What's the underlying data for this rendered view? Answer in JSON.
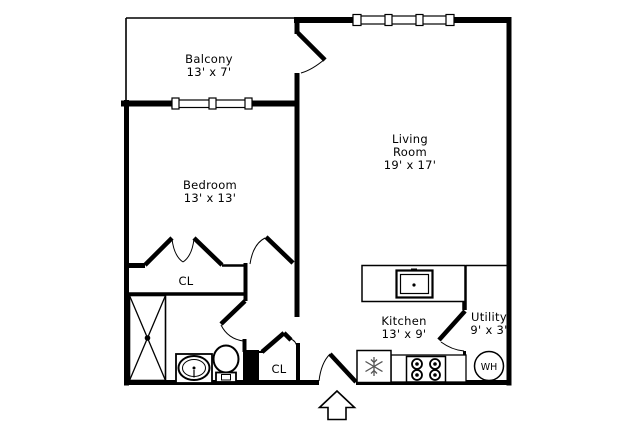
{
  "canvas": {
    "background": "#ffffff",
    "line_color": "#000000"
  },
  "rooms": {
    "balcony": {
      "lines": [
        "Balcony",
        "13' x 7'"
      ]
    },
    "living": {
      "lines": [
        "Living",
        "Room",
        "19' x 17'"
      ]
    },
    "bedroom": {
      "lines": [
        "Bedroom",
        "13' x 13'"
      ]
    },
    "kitchen": {
      "lines": [
        "Kitchen",
        "13' x 9'"
      ]
    },
    "utility": {
      "lines": [
        "Utility",
        "9' x 3'"
      ]
    }
  },
  "closets": {
    "bedroom_closet_label": "CL",
    "entry_closet_label": "CL"
  },
  "fixtures": {
    "water_heater_label": "WH"
  }
}
